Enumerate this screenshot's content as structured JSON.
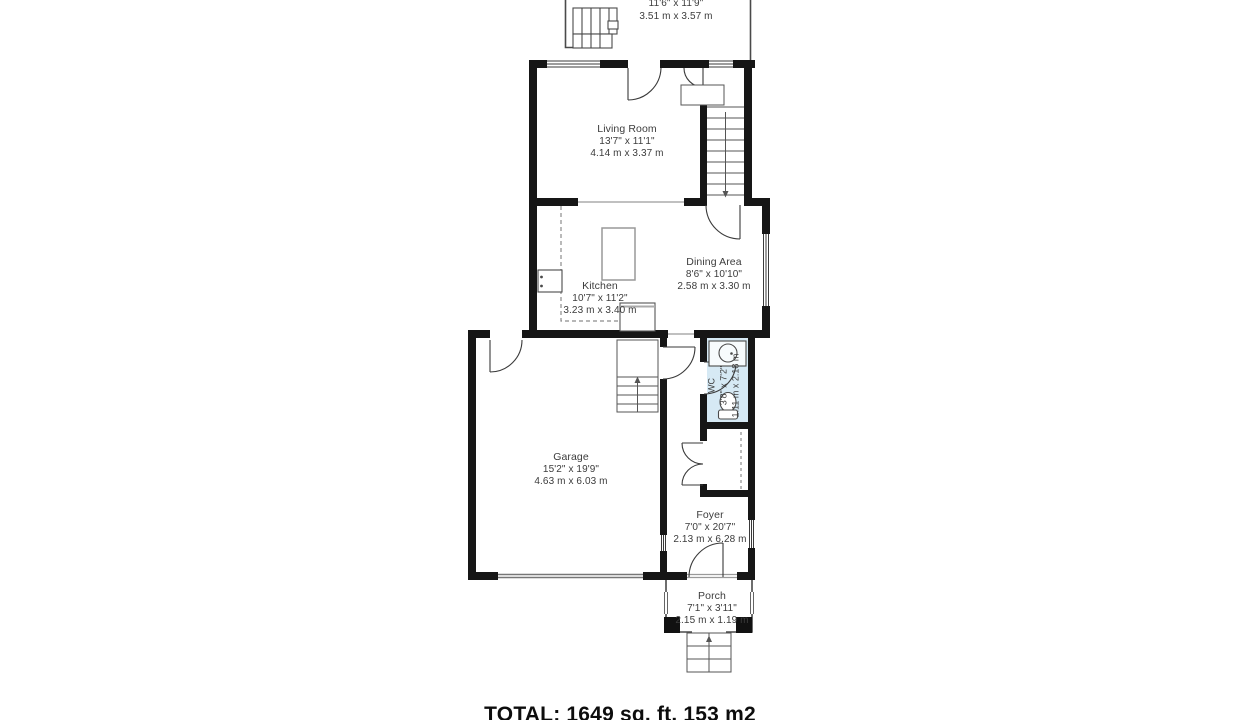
{
  "floorplan": {
    "total_label": "TOTAL: 1649 sq. ft. 153 m2",
    "rooms": [
      {
        "id": "upper-room",
        "name": "",
        "imperial": "11'6\" x 11'9\"",
        "metric": "3.51 m x 3.57 m"
      },
      {
        "id": "living-room",
        "name": "Living Room",
        "imperial": "13'7\" x 11'1\"",
        "metric": "4.14 m x 3.37 m"
      },
      {
        "id": "kitchen",
        "name": "Kitchen",
        "imperial": "10'7\" x 11'2\"",
        "metric": "3.23 m x 3.40 m"
      },
      {
        "id": "dining-area",
        "name": "Dining Area",
        "imperial": "8'6\" x 10'10\"",
        "metric": "2.58 m x 3.30 m"
      },
      {
        "id": "wc",
        "name": "WC",
        "imperial": "3'8\" x 7'2\"",
        "metric": "1.11 m x 2.18 m"
      },
      {
        "id": "garage",
        "name": "Garage",
        "imperial": "15'2\" x 19'9\"",
        "metric": "4.63 m x 6.03 m"
      },
      {
        "id": "foyer",
        "name": "Foyer",
        "imperial": "7'0\" x 20'7\"",
        "metric": "2.13 m x 6.28 m"
      },
      {
        "id": "porch",
        "name": "Porch",
        "imperial": "7'1\" x 3'11\"",
        "metric": "2.15 m x 1.19 m"
      }
    ],
    "colors": {
      "wall": "#161616",
      "wc_fill": "#d6e9f4",
      "label_text": "#3c3c3c"
    }
  }
}
